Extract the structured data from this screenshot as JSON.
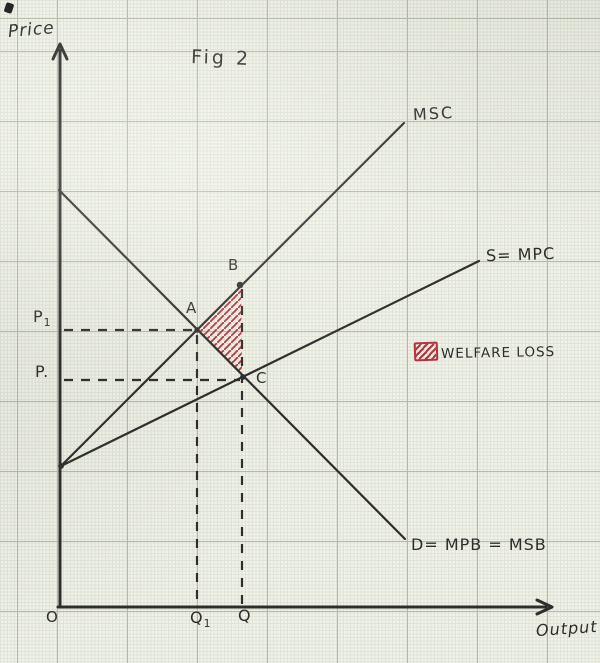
{
  "figure": {
    "title": "Fig 2",
    "y_axis_label": "Price",
    "x_axis_label": "Output",
    "origin_label": "O"
  },
  "curves": {
    "msc": "MSC",
    "supply": "S= MPC",
    "demand": "D= MPB = MSB"
  },
  "points": {
    "a": "A",
    "b": "B",
    "c": "C"
  },
  "prices": {
    "p1_base": "P",
    "p1_sub": "1",
    "p": "P."
  },
  "quantities": {
    "q1_base": "Q",
    "q1_sub": "1",
    "q": "Q"
  },
  "legend": {
    "label": "WELFARE LOSS"
  },
  "colors": {
    "ink": "#2e2d2b",
    "red": "#b5323f",
    "paper": "#f1f3ea",
    "grid_minor": "#dfe3d5",
    "grid_major": "#b3bba8"
  }
}
